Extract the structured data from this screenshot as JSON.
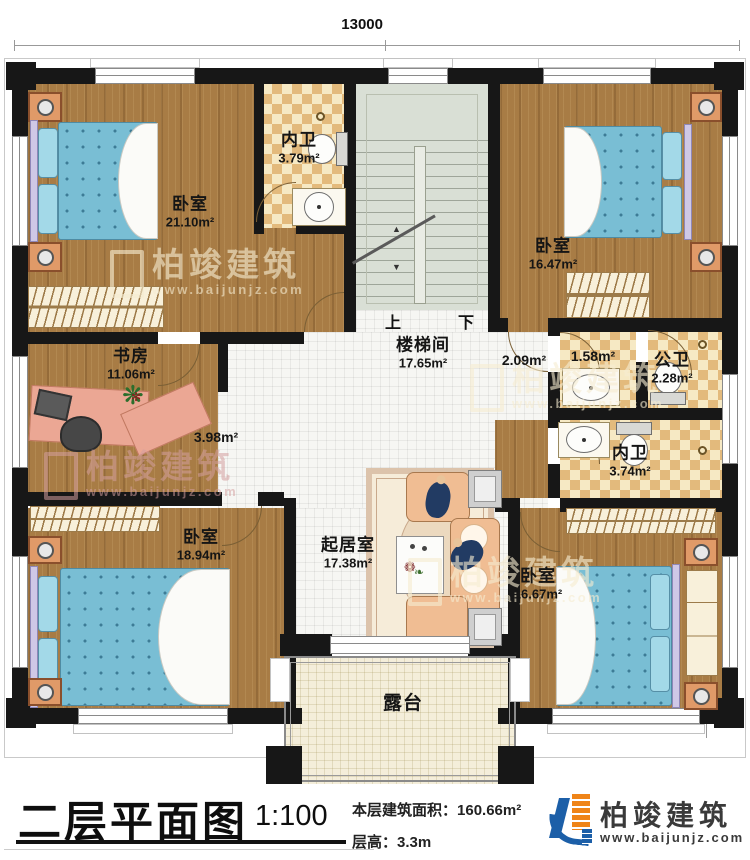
{
  "dimensions": {
    "top": "13000",
    "right": "13200"
  },
  "rooms": {
    "bedroom_tl": {
      "name": "卧室",
      "area": "21.10m²"
    },
    "bath_top": {
      "name": "内卫",
      "area": "3.79m²"
    },
    "bedroom_tr": {
      "name": "卧室",
      "area": "16.47m²"
    },
    "study": {
      "name": "书房",
      "area": "11.06m²"
    },
    "stair_hall": {
      "name": "楼梯间",
      "area": "17.65m²"
    },
    "hall_right": {
      "area": "2.09m²"
    },
    "hall_left": {
      "area": "3.98m²"
    },
    "bath_vestibule": {
      "area": "1.58m²"
    },
    "bath_public": {
      "name": "公卫",
      "area": "2.28m²"
    },
    "bath_inner": {
      "name": "内卫",
      "area": "3.74m²"
    },
    "bedroom_bl": {
      "name": "卧室",
      "area": "18.94m²"
    },
    "living": {
      "name": "起居室",
      "area": "17.38m²"
    },
    "bedroom_br": {
      "name": "卧室",
      "area": "16.67m²"
    },
    "terrace": {
      "name": "露台"
    }
  },
  "stairs": {
    "up": "上",
    "down": "下"
  },
  "titleblock": {
    "title": "二层平面图",
    "scale": "1:100",
    "area_label": "本层建筑面积：",
    "area_value": "160.66m²",
    "height_label": "层高：",
    "height_value": "3.3m"
  },
  "brand": {
    "name": "柏竣建筑",
    "website": "www.baijunjz.com",
    "blue": "#1c5fa8",
    "orange": "#ef8418"
  },
  "watermark": {
    "name": "柏竣建筑",
    "website": "www.baijunjz.com"
  }
}
